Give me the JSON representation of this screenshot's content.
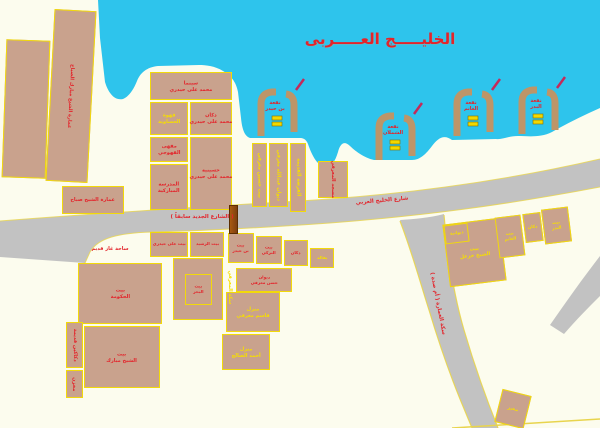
{
  "title": "الخليـــــج العـــــربى",
  "colors": {
    "water": "#2EC4EC",
    "land": "#FCFCEE",
    "bldg": "#C9A28D",
    "bord": "#F2D90A",
    "road": "#C2C2C2",
    "red": "#E3242B",
    "yel": "#F6DE00",
    "pier": "#BD9568",
    "flag": "#C42A5A",
    "boat": "#F2D800",
    "edge": "#E8D44D"
  },
  "roads": {
    "old_street_label": "( الشارع الجديد سابقاً )",
    "gulf_street_label": "شارع الخليج العربي",
    "square_label": "ساحة غاز قديم",
    "diagonal_street_label": "سكة العمارة ( أم صدة )",
    "alley_label": "سكة المعرفي"
  },
  "piers": [
    {
      "label": "نقعة\nبن حيدر"
    },
    {
      "label": "نقعة\nالشملان"
    },
    {
      "label": "نقعة\nالغانم"
    },
    {
      "label": "نقعة\nالبدر"
    }
  ],
  "b": {
    "L2": "عمارة الشيخ مبارك الصباح",
    "L3": "عمارة الشيخ صباح",
    "C1": "سينما\nمحمد على حيدري",
    "C2": "قهوة\nالحساوية",
    "C3": "دكان\nمحمد على حيدري",
    "C4": "مقهى\nالقهوجي",
    "C5": "حسينية\nمحمد على حيدري",
    "C6": "المدرسة\nالمباركية",
    "S1": "بيت حسين معرفي",
    "S2": "ديوان عبدالله معرفي",
    "S3": "الفرضة القديمة",
    "S4": "مسجد المعرفي",
    "R1": "بيت\nالشيخ خزعل",
    "R1a": "ديوانية",
    "R2": "بيت\nالغانم",
    "R3": "دكان",
    "R4": "بيت\nالبدر",
    "E1": "بيت\nالحكومة",
    "E2": "بيت\nالشيخ مبارك",
    "E3": "دكاكين قديمة",
    "E4": "مخزن",
    "F1": "بيت على حيدري",
    "F2": "بيت الرشيد",
    "H": "بيت\nالبحر",
    "G1": "بيت\nبن حيدر",
    "G2": "بيت\nالتركي",
    "G3": "دكان",
    "G4": "بقالة",
    "G5": "ديوان\nحسن معرفي",
    "G6": "منزل\nقاسم معرفي",
    "G7": "منزل\nأحمد الصالح",
    "BR": "مخبز"
  }
}
